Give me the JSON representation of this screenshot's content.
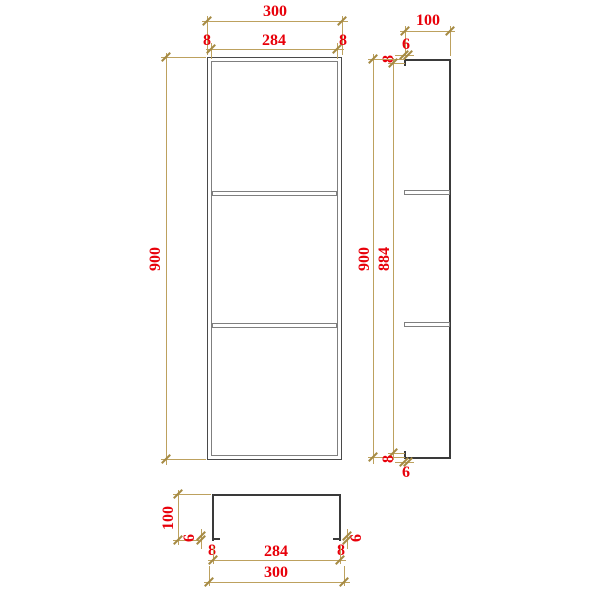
{
  "drawing_title": "niche-shelf-orthographic-views",
  "colors": {
    "dimension_line": "#bda15e",
    "dimension_text": "#e8000a",
    "outline_dark": "#3a3a3a",
    "outline_gray": "#7f7f7f",
    "background": "#ffffff"
  },
  "front_view": {
    "overall_width": "300",
    "inner_width": "284",
    "wall_left": "8",
    "wall_right": "8",
    "overall_height": "900"
  },
  "side_view": {
    "depth": "100",
    "lip_top": "6",
    "wall_top": "8",
    "overall_height": "900",
    "inner_height": "884",
    "wall_bottom": "8",
    "lip_bottom": "6"
  },
  "top_view": {
    "depth": "100",
    "lip_left": "6",
    "wall_left": "8",
    "inner_width": "284",
    "overall_width": "300",
    "wall_right": "8",
    "lip_right": "6"
  }
}
